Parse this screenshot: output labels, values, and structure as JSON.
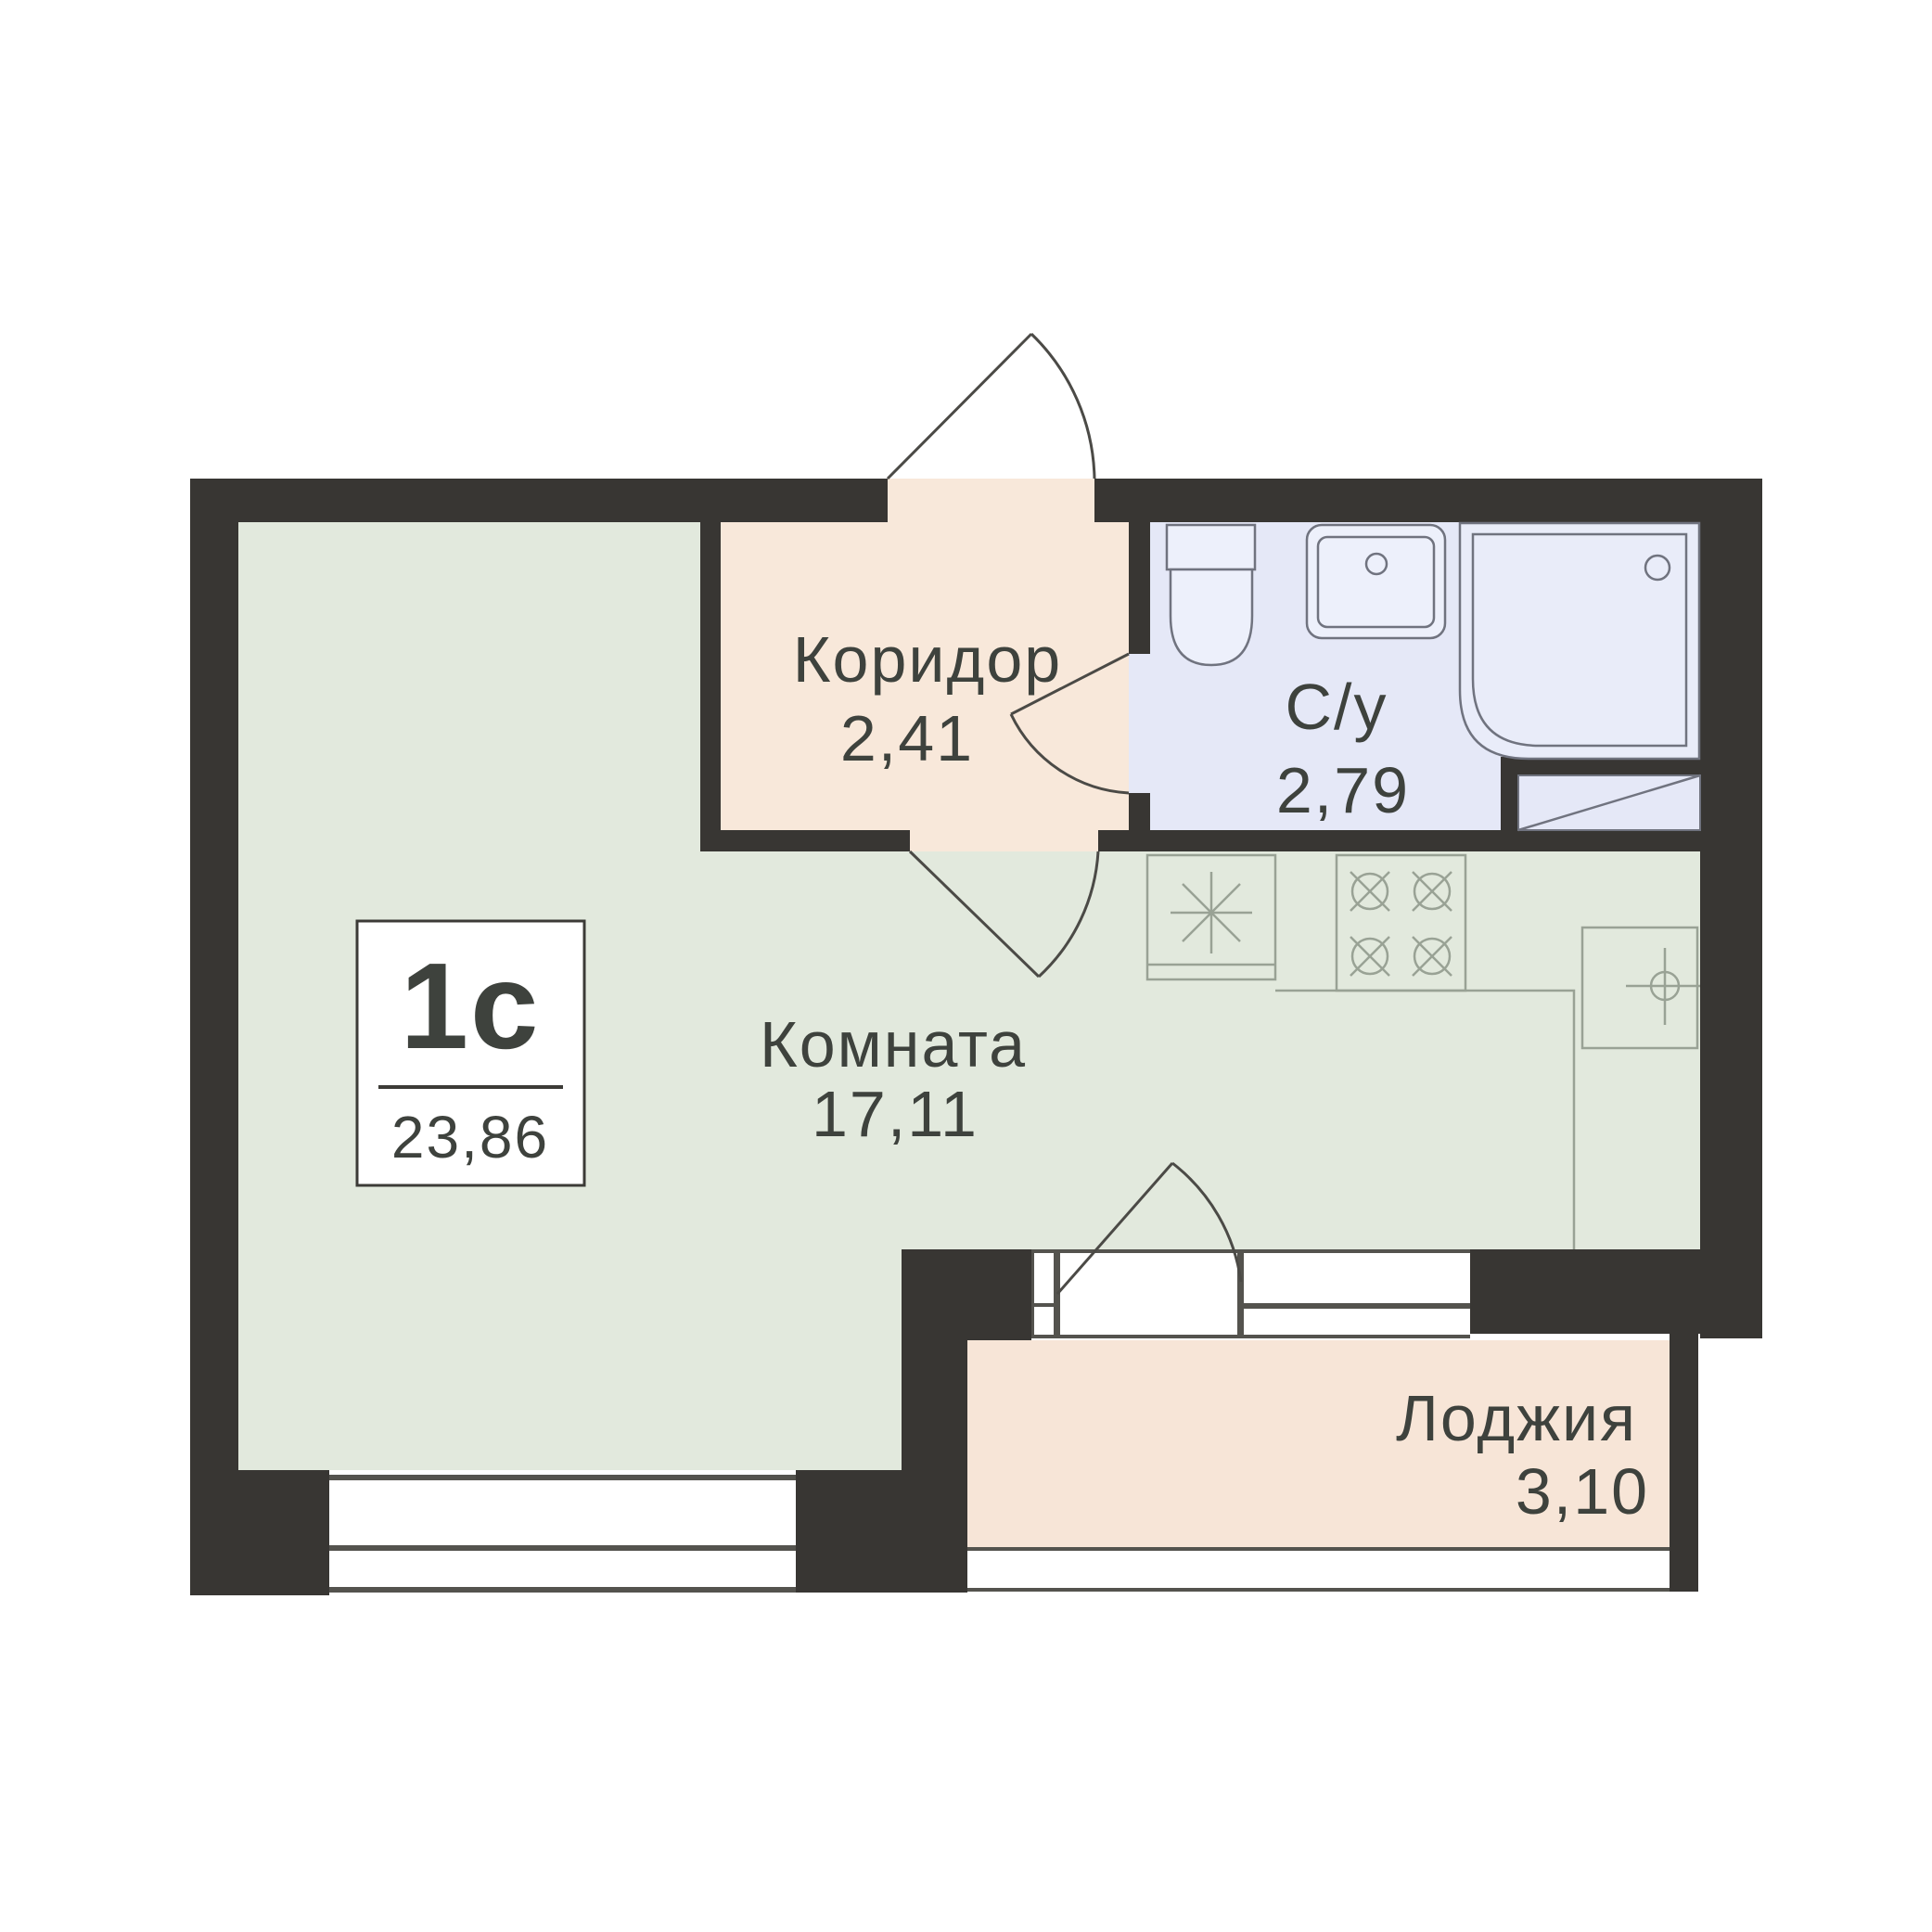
{
  "plan": {
    "unit": {
      "type_label": "1с",
      "total_area": "23,86"
    },
    "rooms": [
      {
        "id": "corridor",
        "name": "Коридор",
        "area": "2,41"
      },
      {
        "id": "bathroom",
        "name": "С/у",
        "area": "2,79"
      },
      {
        "id": "room",
        "name": "Комната",
        "area": "17,11"
      },
      {
        "id": "loggia",
        "name": "Лоджия",
        "area": "3,10"
      }
    ],
    "fixtures": [
      "entrance-door-swing",
      "bathroom-door-swing",
      "room-door-swing",
      "balcony-door-swing",
      "toilet",
      "washbasin",
      "shower-tray",
      "refrigerator-asterisk",
      "stove-4-burners",
      "kitchen-sink-crosshair",
      "window",
      "loggia-glazing"
    ],
    "colors": {
      "wall": "#383633",
      "room": "#e2e9dd",
      "corridor": "#f8e8da",
      "loggia": "#f7e5d7",
      "bath": "#e5e8f7",
      "bath_fixture": "#edf0fb",
      "shower": "#e9ecf9",
      "bath_line": "#70737f",
      "kitchen_line": "#99a295",
      "frame": "#54534e",
      "door": "#4b4a46",
      "text": "#3e423d",
      "label_border": "#3c3b37"
    }
  }
}
